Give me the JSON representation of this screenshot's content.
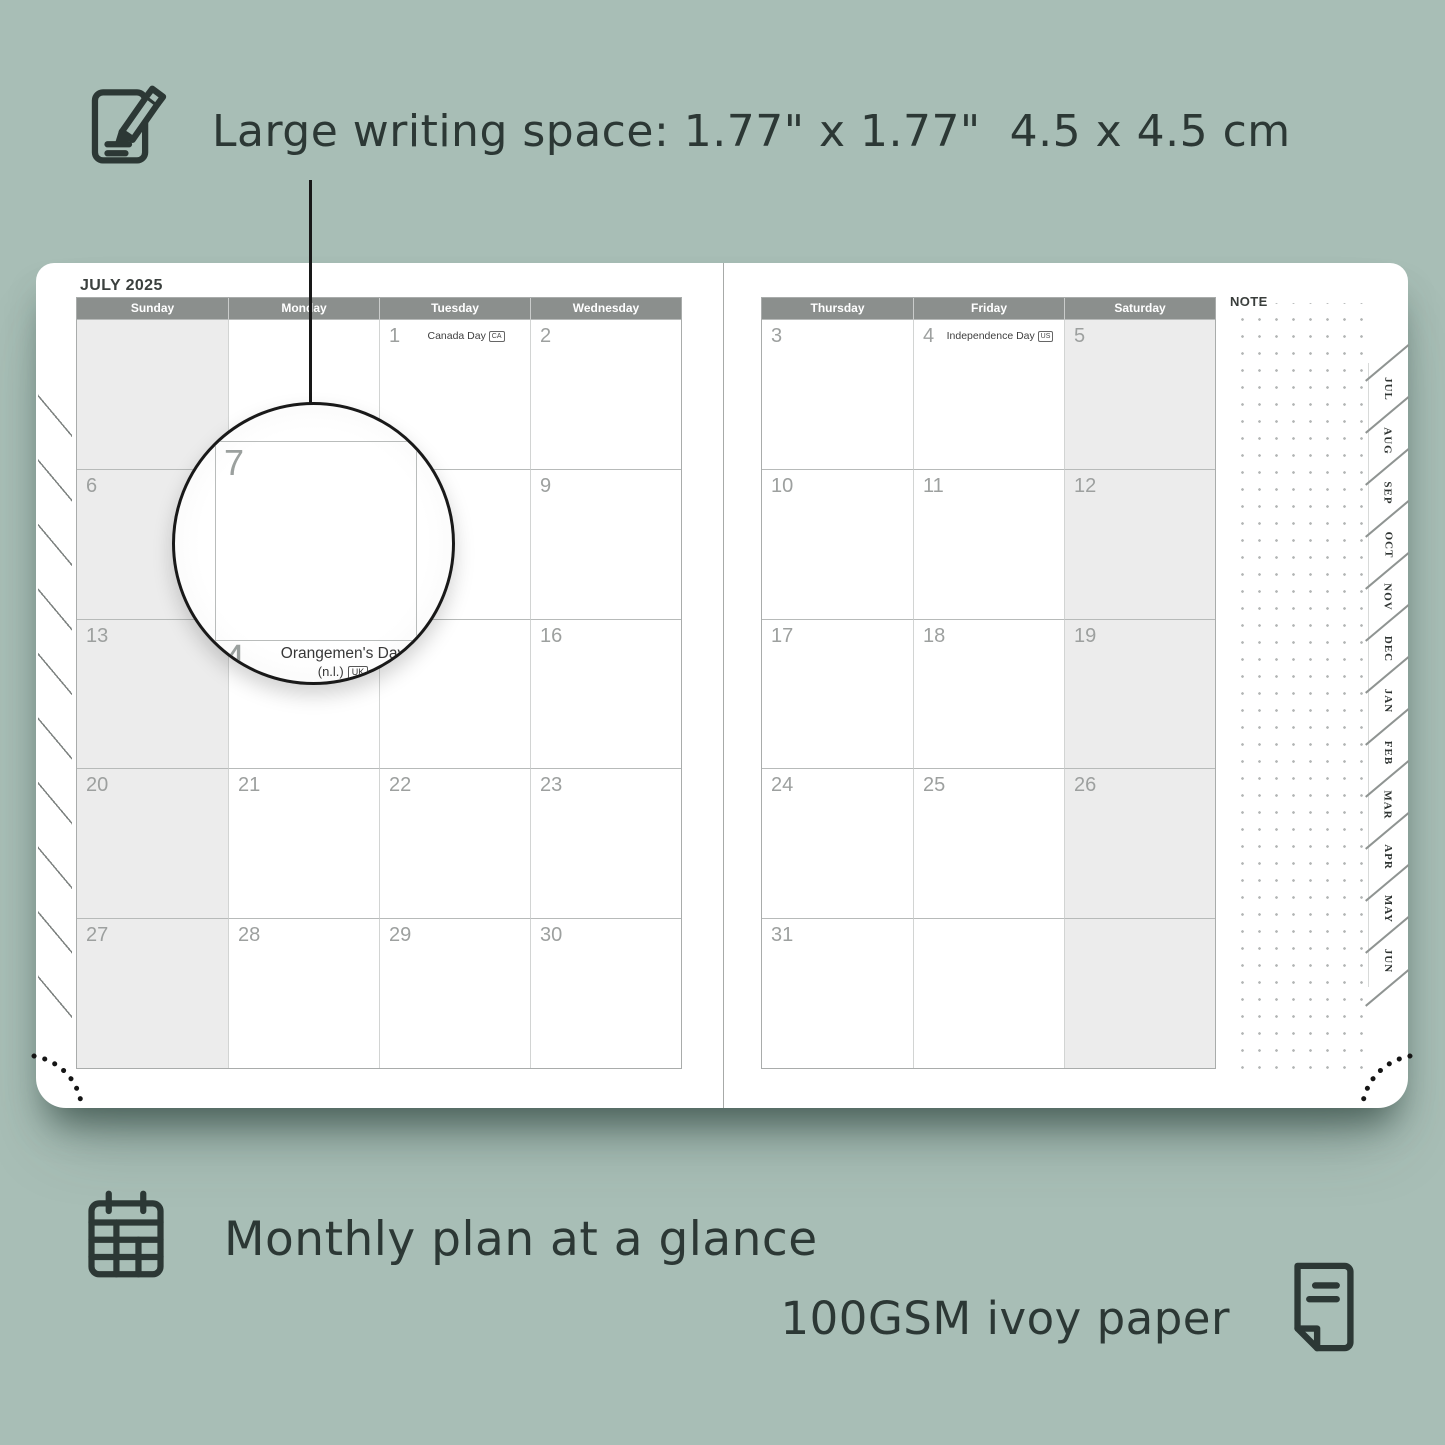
{
  "annotations": {
    "top": "Large writing space: 1.77\" x 1.77\"  4.5 x 4.5 cm",
    "bottom_left": "Monthly plan at a glance",
    "bottom_right": "100GSM ivoy paper"
  },
  "planner": {
    "month_title": "JULY 2025",
    "note_label": "NOTE",
    "left": {
      "day_headers": [
        "Sunday",
        "Monday",
        "Tuesday",
        "Wednesday"
      ],
      "shaded_col": 0,
      "weeks": [
        [
          {
            "d": ""
          },
          {
            "d": ""
          },
          {
            "d": "1",
            "h": "Canada Day",
            "b": "CA"
          },
          {
            "d": "2"
          }
        ],
        [
          {
            "d": "6"
          },
          {
            "d": "7"
          },
          {
            "d": "8"
          },
          {
            "d": "9"
          }
        ],
        [
          {
            "d": "13"
          },
          {
            "d": "14",
            "h": "Orangemen's Day (n.l.)",
            "b": "UK"
          },
          {
            "d": "15"
          },
          {
            "d": "16"
          }
        ],
        [
          {
            "d": "20"
          },
          {
            "d": "21"
          },
          {
            "d": "22"
          },
          {
            "d": "23"
          }
        ],
        [
          {
            "d": "27"
          },
          {
            "d": "28"
          },
          {
            "d": "29"
          },
          {
            "d": "30"
          }
        ]
      ]
    },
    "right": {
      "day_headers": [
        "Thursday",
        "Friday",
        "Saturday"
      ],
      "shaded_col": 2,
      "weeks": [
        [
          {
            "d": "3"
          },
          {
            "d": "4",
            "h": "Independence Day",
            "b": "US"
          },
          {
            "d": "5"
          }
        ],
        [
          {
            "d": "10"
          },
          {
            "d": "11"
          },
          {
            "d": "12"
          }
        ],
        [
          {
            "d": "17"
          },
          {
            "d": "18"
          },
          {
            "d": "19"
          }
        ],
        [
          {
            "d": "24"
          },
          {
            "d": "25"
          },
          {
            "d": "26"
          }
        ],
        [
          {
            "d": "31"
          },
          {
            "d": ""
          },
          {
            "d": ""
          }
        ]
      ]
    },
    "tabs": [
      "JUL",
      "AUG",
      "SEP",
      "OCT",
      "NOV",
      "DEC",
      "JAN",
      "FEB",
      "MAR",
      "APR",
      "MAY",
      "JUN"
    ]
  },
  "magnifier": {
    "magnified_day": "7",
    "partial_day": "4",
    "holiday": "Orangemen's Day",
    "holiday_detail": "(n.l.)",
    "badge": "UK"
  },
  "colors": {
    "background": "#a8beb6",
    "header_bar": "#8b8f8d",
    "weekend_shade": "#ececec",
    "annotation_text": "#2c3835",
    "day_number": "#9da09f",
    "magnifier_border": "#191919"
  }
}
